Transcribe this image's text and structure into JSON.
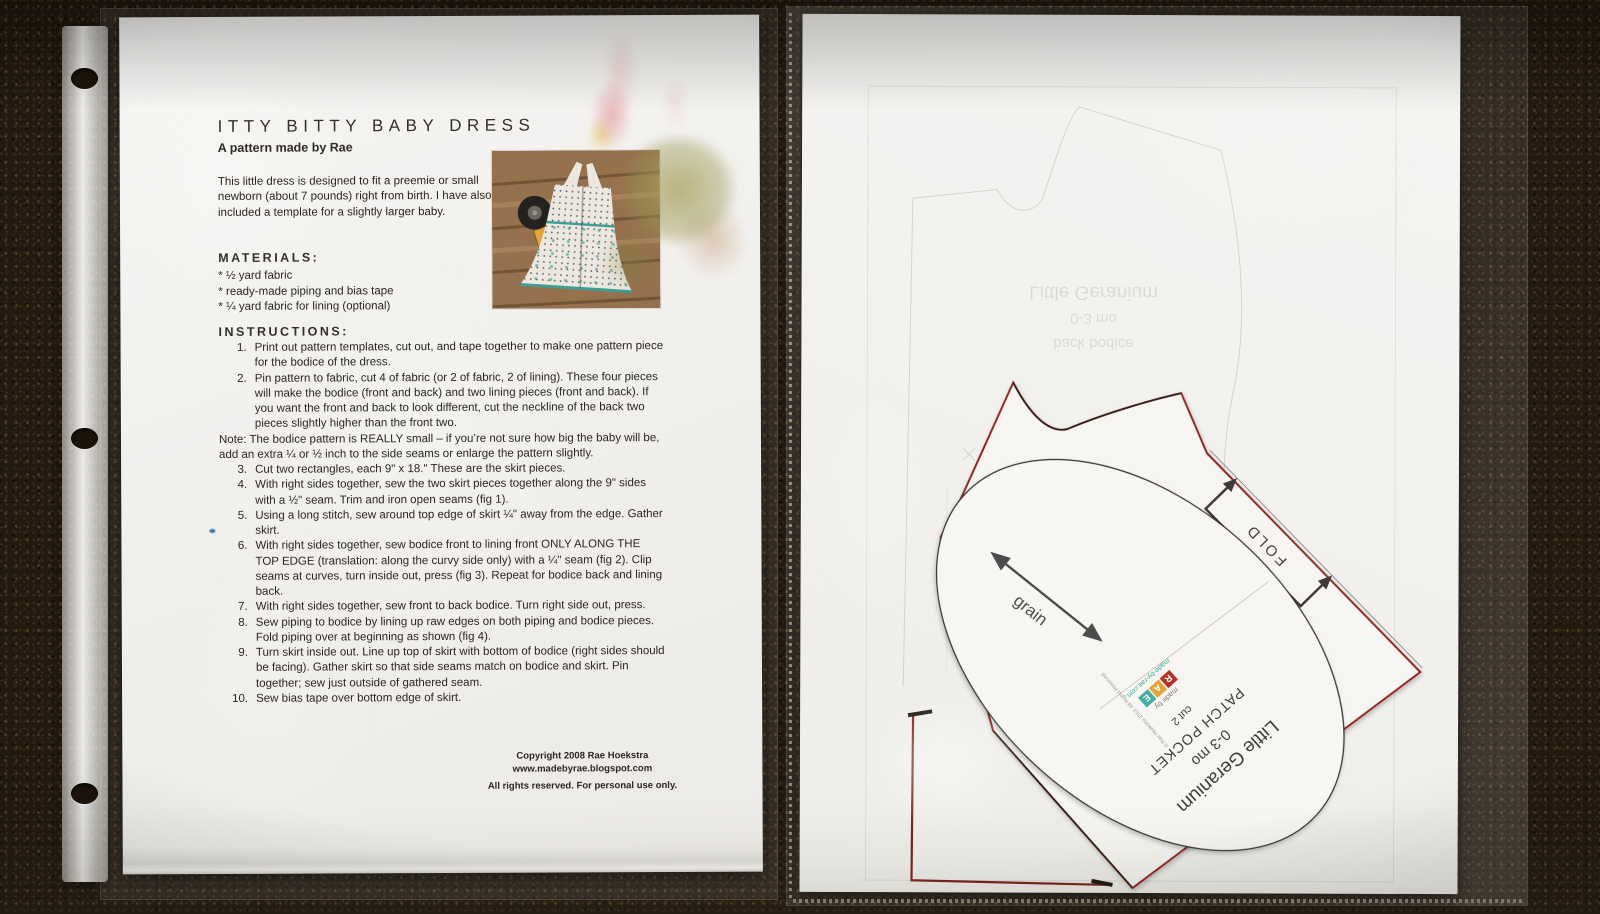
{
  "left_page": {
    "title": "ITTY BITTY BABY DRESS",
    "subtitle": "A pattern made by Rae",
    "intro": "This little dress is designed to fit a preemie or small newborn (about 7 pounds) right from birth.  I have also included a template for a slightly larger baby.",
    "materials_heading": "MATERIALS:",
    "materials": [
      "* ½ yard fabric",
      "* ready-made piping and bias tape",
      "* ¼ yard fabric for lining (optional)"
    ],
    "instructions_heading": "INSTRUCTIONS:",
    "steps": [
      {
        "n": "1.",
        "t": "Print out pattern templates, cut out, and tape together to make one pattern piece for the bodice of the dress."
      },
      {
        "n": "2.",
        "t": "Pin pattern to fabric, cut 4 of fabric (or 2 of fabric, 2 of lining).  These four pieces will make the bodice (front and back) and two lining pieces (front and back).  If you want the front and back to look different, cut the neckline of the back two pieces slightly higher than the front two."
      },
      {
        "n": "3.",
        "t": "Cut two rectangles, each 9\" x 18.\"  These are the skirt pieces."
      },
      {
        "n": "4.",
        "t": "With right sides together, sew the two skirt pieces together along the 9\" sides with a ½\" seam.  Trim and iron open seams (fig 1)."
      },
      {
        "n": "5.",
        "t": "Using a long stitch, sew around top edge of skirt ¼\" away from the edge.  Gather skirt."
      },
      {
        "n": "6.",
        "t": "With right sides together, sew bodice front to lining front ONLY ALONG THE TOP EDGE (translation: along the curvy side only) with a ¼\" seam (fig 2). Clip seams at curves, turn inside out, press (fig 3).  Repeat for bodice back and lining back."
      },
      {
        "n": "7.",
        "t": "With right sides together, sew front to back bodice.  Turn right side out, press."
      },
      {
        "n": "8.",
        "t": "Sew piping to bodice by lining up raw edges on both piping and bodice pieces.  Fold piping over at beginning as shown (fig 4)."
      },
      {
        "n": "9.",
        "t": "Turn skirt inside out.  Line up top of skirt with bottom of bodice (right sides should be facing).  Gather skirt so that side seams match on bodice and skirt.  Pin together; sew just outside of gathered seam."
      },
      {
        "n": "10.",
        "t": "Sew bias tape over bottom edge of skirt."
      }
    ],
    "note": "Note:  The bodice pattern is REALLY small – if you’re not sure how big the baby will be, add an extra ¼ or ½ inch to the side seams or enlarge the pattern slightly.",
    "copyright_line1": "Copyright 2008 Rae Hoekstra",
    "copyright_line2": "www.madebyrae.blogspot.com",
    "copyright_line3": "All rights reserved.  For personal use only."
  },
  "right_page": {
    "cutout": {
      "fold_label": "FOLD",
      "grain_label": "grain"
    },
    "pocket": {
      "line1": "Little Geranium",
      "line2": "0-3 mo",
      "line3": "PATCH POCKET",
      "line4": "cut 2"
    },
    "logo": {
      "made_by": "made by",
      "letters": [
        "R",
        "A",
        "E"
      ],
      "site": "made-by-rae.com",
      "rights": "© Rae Hoekstra 2012. All Rights Reserved"
    },
    "show_through": {
      "line1": "Little Geranium",
      "line2": "0-3 mo",
      "line3": "back bodice"
    }
  },
  "colors": {
    "accent_red": "#8c2620",
    "logo_red": "#b5342a",
    "logo_amber": "#e0a63c",
    "logo_teal": "#45ada0",
    "carpet": "#221910",
    "paper": "#f2f1ee"
  }
}
